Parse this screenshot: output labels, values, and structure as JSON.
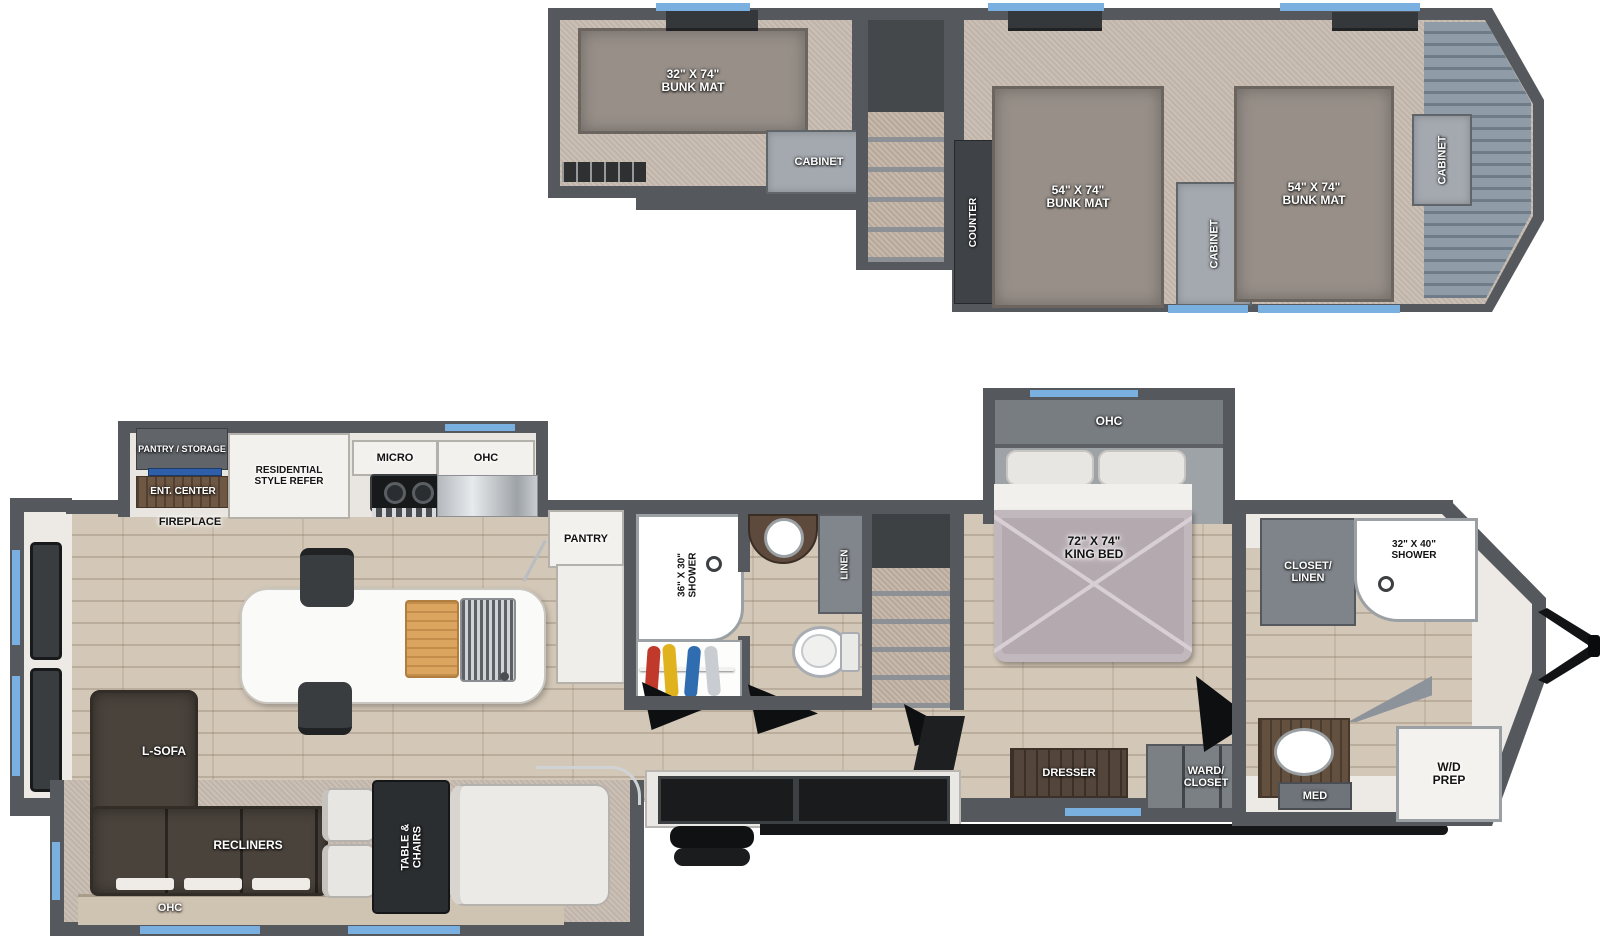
{
  "colors": {
    "window_accent_blue": "#79b0df",
    "wall_gray": "#55585c",
    "loft_carpet_tan": "#c8bcb1",
    "wood_floor_tan": "#d3c7b7",
    "front_deck_blue_gray": "#82909d"
  },
  "loft": {
    "bunk_left": "32\" X 74\"\nBUNK MAT",
    "cabinet_left": "CABINET",
    "counter": "COUNTER",
    "bunk_mid": "54\" X 74\"\nBUNK MAT",
    "cabinet_mid": "CABINET",
    "bunk_right": "54\" X 74\"\nBUNK MAT",
    "cabinet_right": "CABINET"
  },
  "main": {
    "kitchen": {
      "pantry_storage": "PANTRY / STORAGE",
      "ent_center": "ENT. CENTER",
      "fireplace": "FIREPLACE",
      "refer": "RESIDENTIAL\nSTYLE REFER",
      "micro": "MICRO",
      "ohc": "OHC",
      "pantry": "PANTRY"
    },
    "bath": {
      "shower": "36\" X 30\"\nSHOWER",
      "linen": "LINEN"
    },
    "living": {
      "sofa": "L-SOFA",
      "recliners": "RECLINERS",
      "ohc": "OHC",
      "dinette": "TABLE &\nCHAIRS"
    },
    "bedroom": {
      "bed": "72\" X 74\"\nKING BED",
      "ohc": "OHC",
      "dresser": "DRESSER",
      "wardrobe": "WARD/\nCLOSET"
    },
    "front_bath": {
      "closet": "CLOSET/\nLINEN",
      "shower": "32\" X 40\"\nSHOWER",
      "med": "MED",
      "wd": "W/D\nPREP"
    }
  }
}
